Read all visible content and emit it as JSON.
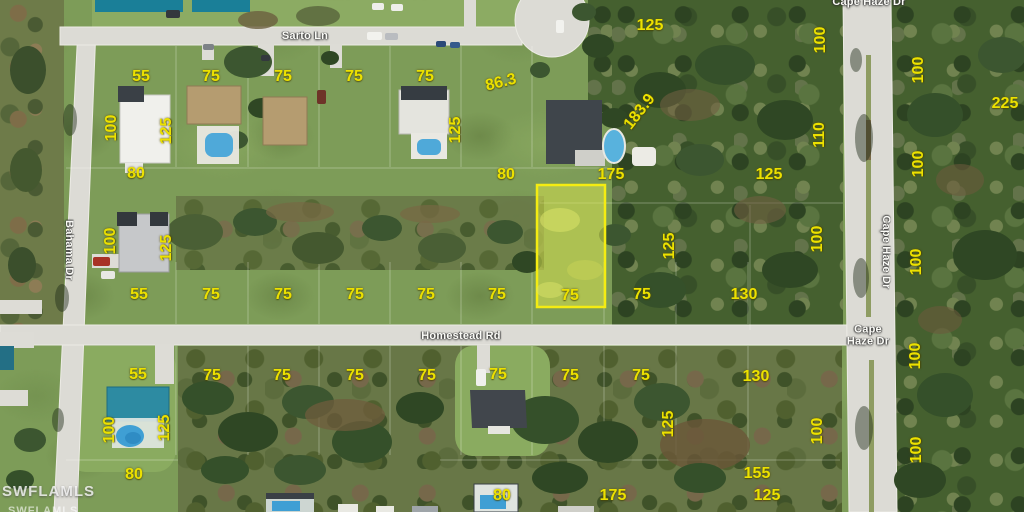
{
  "map": {
    "description": "aerial parcel map with lot dimension overlays",
    "streets": {
      "sarto_ln": "Sarto Ln",
      "homestead_rd": "Homestead Rd",
      "cape_haze_dr": "Cape Haze Dr",
      "bahama_dr": "Bahama Dr"
    },
    "street_labels": [
      {
        "text": "Sarto Ln",
        "x": 305,
        "y": 37,
        "rot": 0
      },
      {
        "text": "Cape Haze Dr",
        "x": 869,
        "y": 3,
        "rot": 0
      },
      {
        "text": "Cape Haze Dr",
        "x": 885,
        "y": 252,
        "rot": 90
      },
      {
        "text": "Cape Haze Dr",
        "x": 868,
        "y": 336,
        "rot": 0,
        "wrap": true
      },
      {
        "text": "Homestead Rd",
        "x": 461,
        "y": 337,
        "rot": 0
      },
      {
        "text": "Bahama Dr",
        "x": 68,
        "y": 250,
        "rot": 90
      }
    ],
    "lot_dimensions": [
      {
        "t": "55",
        "x": 141,
        "y": 77
      },
      {
        "t": "75",
        "x": 211,
        "y": 77
      },
      {
        "t": "75",
        "x": 283,
        "y": 77
      },
      {
        "t": "75",
        "x": 354,
        "y": 77
      },
      {
        "t": "75",
        "x": 425,
        "y": 77
      },
      {
        "t": "86.3",
        "x": 501,
        "y": 83,
        "r": -14
      },
      {
        "t": "183.9",
        "x": 640,
        "y": 112,
        "r": -52
      },
      {
        "t": "125",
        "x": 650,
        "y": 26
      },
      {
        "t": "75",
        "x": 251,
        "y": -7
      },
      {
        "t": "125",
        "x": 339,
        "y": -6
      },
      {
        "t": "75",
        "x": 420,
        "y": -6
      },
      {
        "t": "8",
        "x": 493,
        "y": -7
      },
      {
        "t": "100",
        "x": 112,
        "y": 128,
        "r": -90
      },
      {
        "t": "125",
        "x": 167,
        "y": 131,
        "r": -90
      },
      {
        "t": "80",
        "x": 136,
        "y": 174
      },
      {
        "t": "125",
        "x": 456,
        "y": 130,
        "r": -90
      },
      {
        "t": "80",
        "x": 506,
        "y": 175
      },
      {
        "t": "175",
        "x": 611,
        "y": 175
      },
      {
        "t": "125",
        "x": 769,
        "y": 175
      },
      {
        "t": "125",
        "x": 670,
        "y": 246,
        "r": -90
      },
      {
        "t": "100",
        "x": 821,
        "y": 40,
        "r": -90
      },
      {
        "t": "110",
        "x": 820,
        "y": 135,
        "r": -90
      },
      {
        "t": "100",
        "x": 818,
        "y": 239,
        "r": -90
      },
      {
        "t": "100",
        "x": 818,
        "y": 431,
        "r": -90
      },
      {
        "t": "100",
        "x": 919,
        "y": 70,
        "r": -90
      },
      {
        "t": "225",
        "x": 1005,
        "y": 104
      },
      {
        "t": "100",
        "x": 919,
        "y": 164,
        "r": -90
      },
      {
        "t": "100",
        "x": 917,
        "y": 262,
        "r": -90
      },
      {
        "t": "100",
        "x": 916,
        "y": 356,
        "r": -90
      },
      {
        "t": "100",
        "x": 917,
        "y": 450,
        "r": -90
      },
      {
        "t": "55",
        "x": 139,
        "y": 295
      },
      {
        "t": "75",
        "x": 211,
        "y": 295
      },
      {
        "t": "75",
        "x": 283,
        "y": 295
      },
      {
        "t": "75",
        "x": 355,
        "y": 295
      },
      {
        "t": "75",
        "x": 426,
        "y": 295
      },
      {
        "t": "75",
        "x": 497,
        "y": 295
      },
      {
        "t": "75",
        "x": 570,
        "y": 296
      },
      {
        "t": "75",
        "x": 642,
        "y": 295
      },
      {
        "t": "130",
        "x": 744,
        "y": 295
      },
      {
        "t": "100",
        "x": 111,
        "y": 241,
        "r": -90
      },
      {
        "t": "125",
        "x": 167,
        "y": 248,
        "r": -90
      },
      {
        "t": "55",
        "x": 138,
        "y": 375
      },
      {
        "t": "75",
        "x": 212,
        "y": 376
      },
      {
        "t": "75",
        "x": 282,
        "y": 376
      },
      {
        "t": "75",
        "x": 355,
        "y": 376
      },
      {
        "t": "75",
        "x": 427,
        "y": 376
      },
      {
        "t": "75",
        "x": 498,
        "y": 375
      },
      {
        "t": "75",
        "x": 570,
        "y": 376
      },
      {
        "t": "75",
        "x": 641,
        "y": 376
      },
      {
        "t": "130",
        "x": 756,
        "y": 377
      },
      {
        "t": "125",
        "x": 669,
        "y": 424,
        "r": -90
      },
      {
        "t": "100",
        "x": 110,
        "y": 430,
        "r": -90
      },
      {
        "t": "125",
        "x": 165,
        "y": 428,
        "r": -90
      },
      {
        "t": "80",
        "x": 134,
        "y": 475
      },
      {
        "t": "155",
        "x": 757,
        "y": 474
      },
      {
        "t": "80",
        "x": 502,
        "y": 496
      },
      {
        "t": "175",
        "x": 613,
        "y": 496
      },
      {
        "t": "125",
        "x": 767,
        "y": 496
      }
    ],
    "highlighted_parcel": {
      "border_color": "#f4ec12",
      "frontage_label": "75",
      "side_label": "175",
      "rear_label": "125"
    },
    "watermark": "SWFLAMLS",
    "colors": {
      "annotation_yellow": "#ece100",
      "road_gray": "#dcdbd5",
      "street_text": "#fbfbf7",
      "parcel_fill": "#d6e04e"
    }
  }
}
